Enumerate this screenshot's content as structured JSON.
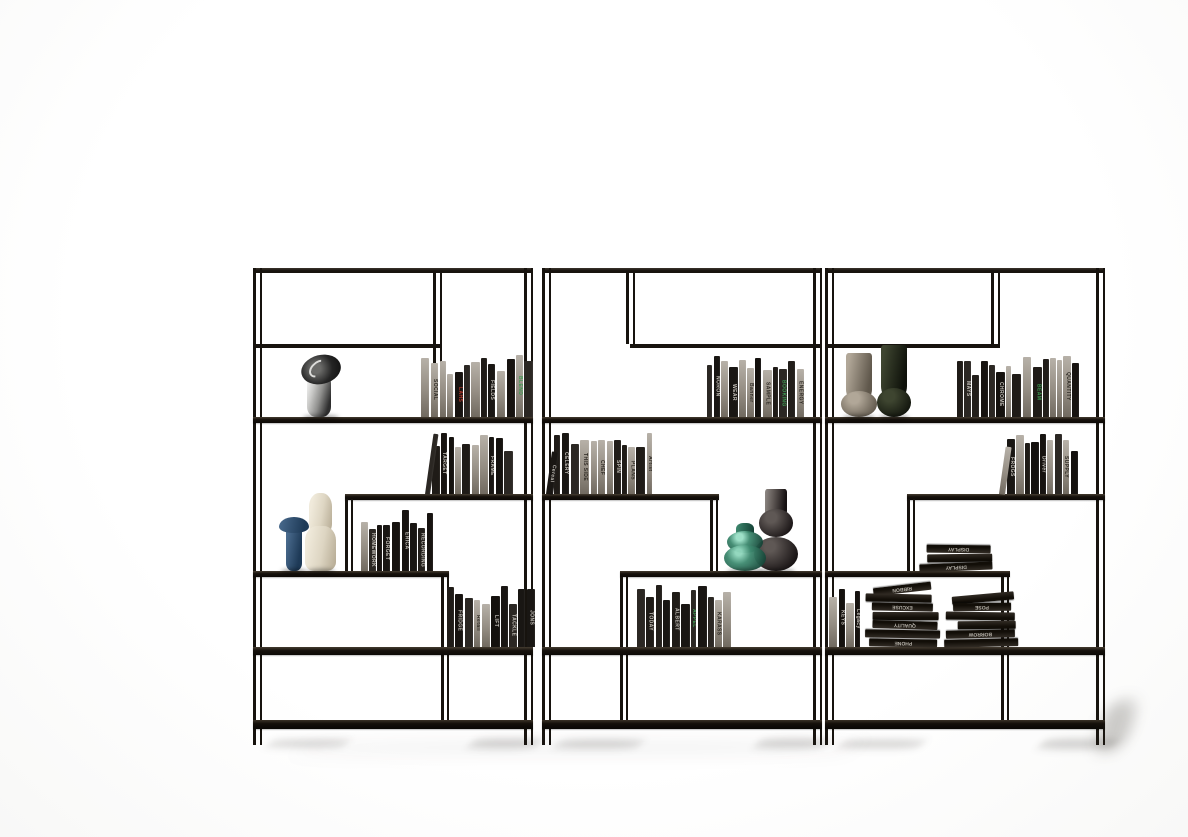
{
  "scene": {
    "type": "product-photo",
    "subject": "Three modular black metal open bookshelf units with staggered shelves, styled with books and decorative vases on a white studio background",
    "background_color": "#ffffff",
    "frame_color": "#17130e",
    "shelf_color": "#16110c",
    "accent_red": "#b5382b",
    "accent_green": "#3e9b52"
  },
  "book_groups": {
    "u1-a": {
      "count": 13,
      "titles": [
        "SOCIAL",
        "LAHS",
        "FIELDS",
        "BLEND"
      ],
      "accents": {
        "LAHS": "#b5382b",
        "BLEND": "#3e9b52"
      }
    },
    "u1-b": {
      "count": 11,
      "titles": [
        "TARGET",
        "FRAME"
      ],
      "accents": {}
    },
    "u1-c": {
      "count": 9,
      "titles": [
        "HOMEWORK",
        "FORGET",
        "ERICA",
        "RECORDING"
      ],
      "accents": {}
    },
    "u1-d": {
      "count": 10,
      "titles": [
        "FRIDGE",
        "Retail",
        "LIFT",
        "TACKLE",
        "JONS"
      ],
      "accents": {}
    },
    "u2-a": {
      "count": 12,
      "titles": [
        "NORON",
        "WEAR",
        "Banner",
        "SAMPLE",
        "BOOKING",
        "ENERGY"
      ],
      "accents": {
        "BOOKING": "#3e9b52"
      }
    },
    "u2-b": {
      "count": 13,
      "titles": [
        "Cereal",
        "CELERY",
        "THIS SIDE",
        "CHEF",
        "SPIN",
        "PLANS",
        "Artist"
      ],
      "accents": {}
    },
    "u2-d": {
      "count": 11,
      "titles": [
        "TODAY",
        "ALBERT",
        "APPEL",
        "KARASS"
      ],
      "accents": {
        "APPEL": "#3e9b52"
      }
    },
    "u3-a": {
      "count": 15,
      "titles": [
        "MAYS",
        "CHROME",
        "BEAM",
        "QUANTITY"
      ],
      "accents": {
        "BEAM": "#3e9b52"
      }
    },
    "u3-b": {
      "count": 10,
      "titles": [
        "FROGS",
        "Driver",
        "SUPPLY"
      ],
      "accents": {}
    },
    "u3-d-upright": {
      "count": 4,
      "titles": [
        "KEYS",
        "Legacy"
      ],
      "accents": {}
    }
  },
  "stacks": {
    "u3-c-stack": {
      "count": 3,
      "titles": [
        "DISPLAY",
        "DISPLAY"
      ],
      "tilt_top": false
    },
    "u3-d-pile1": {
      "count": 7,
      "titles": [
        "RIBBON",
        "EXCUSE",
        "QUALITY",
        "PHONE"
      ],
      "tilt_top": true
    },
    "u3-d-pile2": {
      "count": 6,
      "titles": [
        "POSE",
        "BORROW"
      ],
      "tilt_top": true
    }
  },
  "objects": {
    "u1-sculpture": {
      "name": "chrome abstract head sculpture",
      "color_light": "#f2f2f1",
      "color_dark": "#2e2e2e",
      "color_top": "#0c0c0c"
    },
    "u1-cream-vase": {
      "name": "tall cream ceramic vase",
      "color_light": "#f0eadb",
      "color_dark": "#b4a992"
    },
    "u1-blue-vase": {
      "name": "blue goblet vase",
      "color_light": "#4a6b8e",
      "color_dark": "#1e3a57"
    },
    "u2-teal-vase": {
      "name": "teal glass bubble vase",
      "color_light": "#3f8a70",
      "color_dark": "#123f33"
    },
    "u2-smoke-vase": {
      "name": "smoked glass bubble vase",
      "color_light": "#5f5855",
      "color_dark": "#161112"
    },
    "u3-taupe-vase": {
      "name": "taupe hourglass vase",
      "color_light": "#b1a798",
      "color_dark": "#5f574b"
    },
    "u3-olive-vase": {
      "name": "dark olive hourglass vase",
      "color_light": "#3e4530",
      "color_dark": "#0e110a"
    }
  }
}
